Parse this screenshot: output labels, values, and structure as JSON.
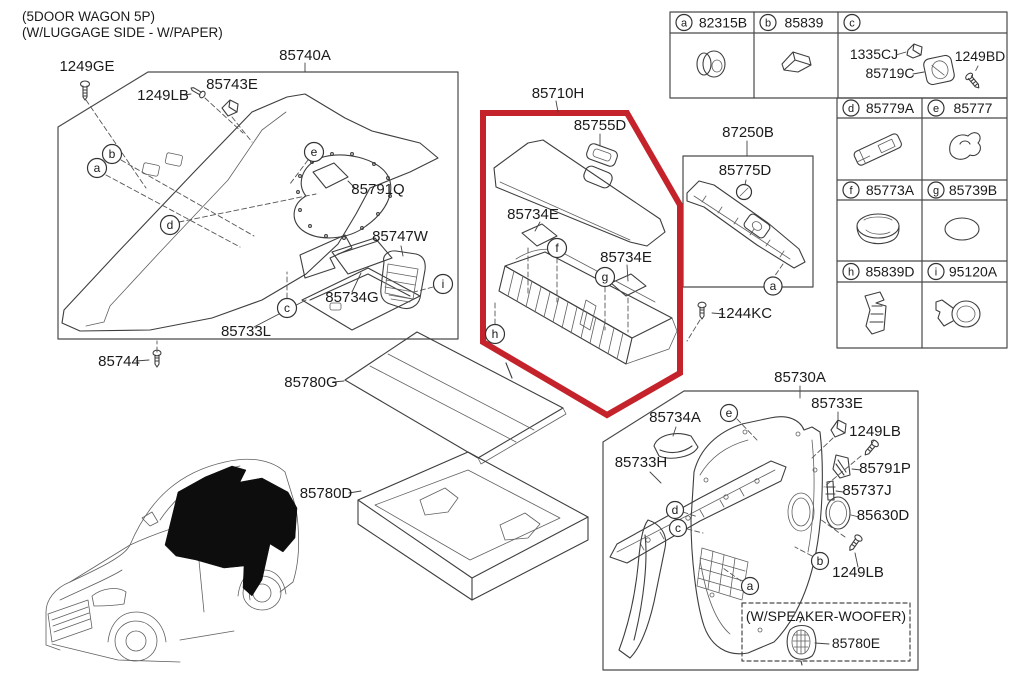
{
  "page": {
    "title_line1": "(5DOOR WAGON 5P)",
    "title_line2": "(W/LUGGAGE SIDE - W/PAPER)"
  },
  "colors": {
    "line": "#3e3e3e",
    "highlight": "#c4232b",
    "text": "#1b1b1b"
  },
  "labels": {
    "p85740A": "85740A",
    "p1249GE": "1249GE",
    "p1249LB": "1249LB",
    "p85743E": "85743E",
    "p85791Q": "85791Q",
    "p85747W": "85747W",
    "p85734G": "85734G",
    "p85733L": "85733L",
    "p85744": "85744",
    "p85780G": "85780G",
    "p85780D": "85780D",
    "p85710H": "85710H",
    "p85755D": "85755D",
    "p85734E": "85734E",
    "p87250B": "87250B",
    "p85775D": "85775D",
    "p1244KC": "1244KC",
    "p85730A": "85730A",
    "p85734A": "85734A",
    "p85733H": "85733H",
    "p85733E": "85733E",
    "p85791P": "85791P",
    "p85737J": "85737J",
    "p85630D": "85630D",
    "p85780E": "85780E",
    "speaker_caption": "(W/SPEAKER-WOOFER)"
  },
  "ref_marks": {
    "a": "a",
    "b": "b",
    "c": "c",
    "d": "d",
    "e": "e",
    "f": "f",
    "g": "g",
    "h": "h",
    "i": "i"
  },
  "table": {
    "row1": [
      {
        "letter": "a",
        "part": "82315B"
      },
      {
        "letter": "b",
        "part": "85839"
      },
      {
        "letter": "c",
        "part": ""
      }
    ],
    "c_cell": {
      "l1": "1335CJ",
      "l2": "85719C",
      "l3": "1249BD"
    },
    "row2": [
      {
        "letter": "d",
        "part": "85779A"
      },
      {
        "letter": "e",
        "part": "85777"
      }
    ],
    "row3": [
      {
        "letter": "f",
        "part": "85773A"
      },
      {
        "letter": "g",
        "part": "85739B"
      }
    ],
    "row4": [
      {
        "letter": "h",
        "part": "85839D"
      },
      {
        "letter": "i",
        "part": "95120A"
      }
    ]
  }
}
